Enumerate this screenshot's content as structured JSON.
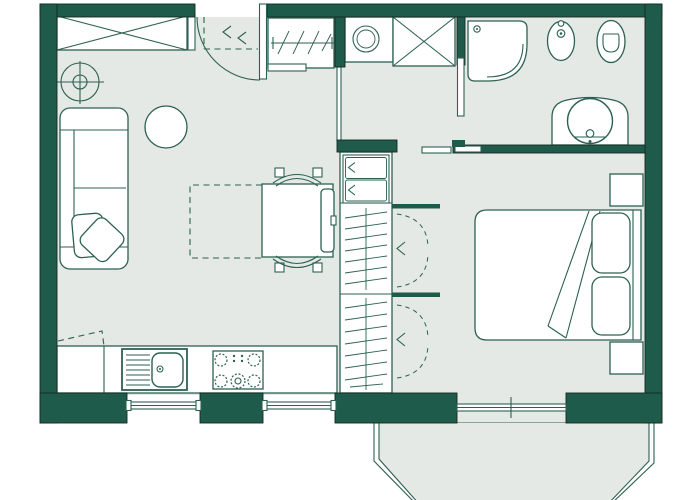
{
  "colors": {
    "wall": "#1f5b4a",
    "wall_outline": "#142a21",
    "line": "#2d6052",
    "floor": "#e4e9e6",
    "paper": "#ffffff"
  },
  "plan": {
    "type": "apartment-floor-plan",
    "rooms": [
      {
        "name": "living-room",
        "fixtures": [
          "wardrobe",
          "ceiling-lamp",
          "sofa",
          "throw-pillows",
          "side-table",
          "dining-table",
          "table-extension-dashed",
          "dining-chairs"
        ]
      },
      {
        "name": "kitchen",
        "fixtures": [
          "counter",
          "kitchen-sink",
          "stove",
          "planned-counter-dashed"
        ]
      },
      {
        "name": "entry-hall",
        "fixtures": [
          "entrance-door",
          "coat-rack",
          "overhead-storage-dashed",
          "washing-machine",
          "storage-cabinet"
        ]
      },
      {
        "name": "hallway-closet",
        "fixtures": [
          "drawer-unit",
          "hanging-rail-upper",
          "hanging-rail-lower",
          "folding-doors"
        ]
      },
      {
        "name": "bathroom",
        "fixtures": [
          "corner-shower",
          "bidet",
          "toilet",
          "washbasin",
          "sliding-door",
          "side-door"
        ]
      },
      {
        "name": "bedroom",
        "fixtures": [
          "double-bed",
          "pillows",
          "blanket-fold",
          "nightstand-upper",
          "nightstand-lower",
          "french-window"
        ]
      },
      {
        "name": "balcony",
        "fixtures": [
          "bay-railing"
        ]
      }
    ],
    "window_openings": 3
  }
}
